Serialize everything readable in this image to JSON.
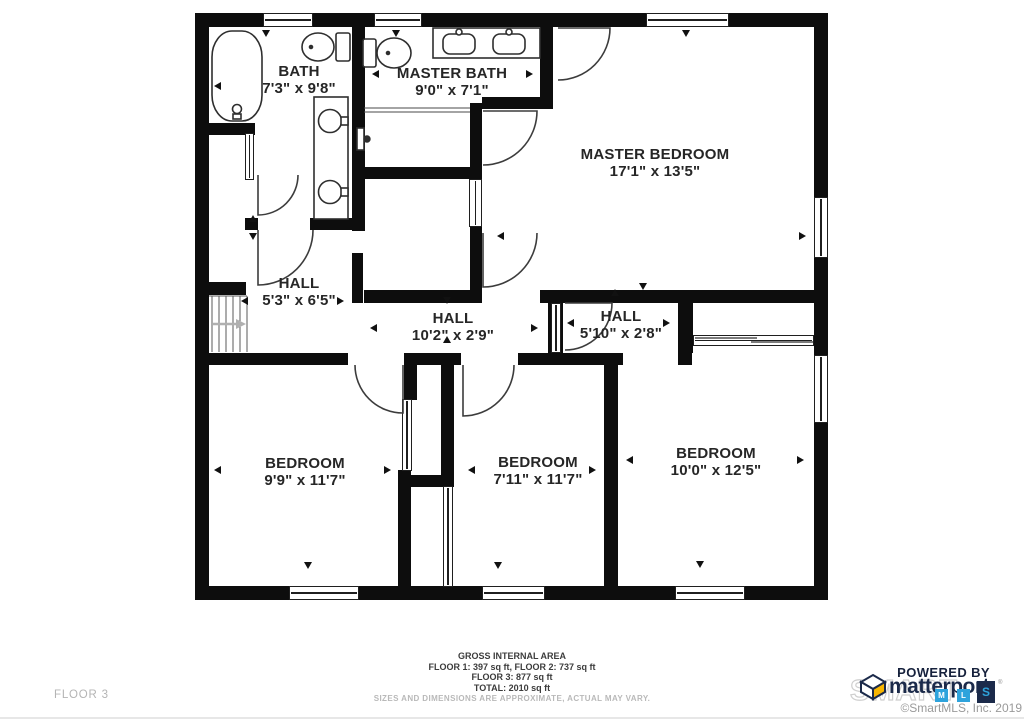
{
  "floor_label": "FLOOR 3",
  "rooms": [
    {
      "name": "BATH",
      "dims": "7'3\" x 9'8\""
    },
    {
      "name": "MASTER BATH",
      "dims": "9'0\" x 7'1\""
    },
    {
      "name": "MASTER BEDROOM",
      "dims": "17'1\" x 13'5\""
    },
    {
      "name": "HALL",
      "dims": "5'3\" x 6'5\""
    },
    {
      "name": "HALL",
      "dims": "10'2\" x 2'9\""
    },
    {
      "name": "HALL",
      "dims": "5'10\" x 2'8\""
    },
    {
      "name": "BEDROOM",
      "dims": "9'9\" x 11'7\""
    },
    {
      "name": "BEDROOM",
      "dims": "7'11\" x 11'7\""
    },
    {
      "name": "BEDROOM",
      "dims": "10'0\" x 12'5\""
    }
  ],
  "footer": {
    "title": "GROSS INTERNAL AREA",
    "line1": "FLOOR 1: 397 sq ft, FLOOR 2: 737 sq ft",
    "line2": "FLOOR 3: 877 sq ft",
    "line3": "TOTAL: 2010 sq ft",
    "disclaimer": "SIZES AND DIMENSIONS ARE APPROXIMATE, ACTUAL MAY VARY."
  },
  "branding": {
    "powered_by": "POWERED BY",
    "logo_text": "matterport",
    "watermark": "SMART",
    "mls_letters": [
      "M",
      "L",
      "S"
    ],
    "copyright": "©SmartMLS, Inc. 2019",
    "navy": "#1b2a4a",
    "blue": "#2ea3dc",
    "yellow": "#f7b500",
    "wall_color": "#0d0d0d"
  }
}
